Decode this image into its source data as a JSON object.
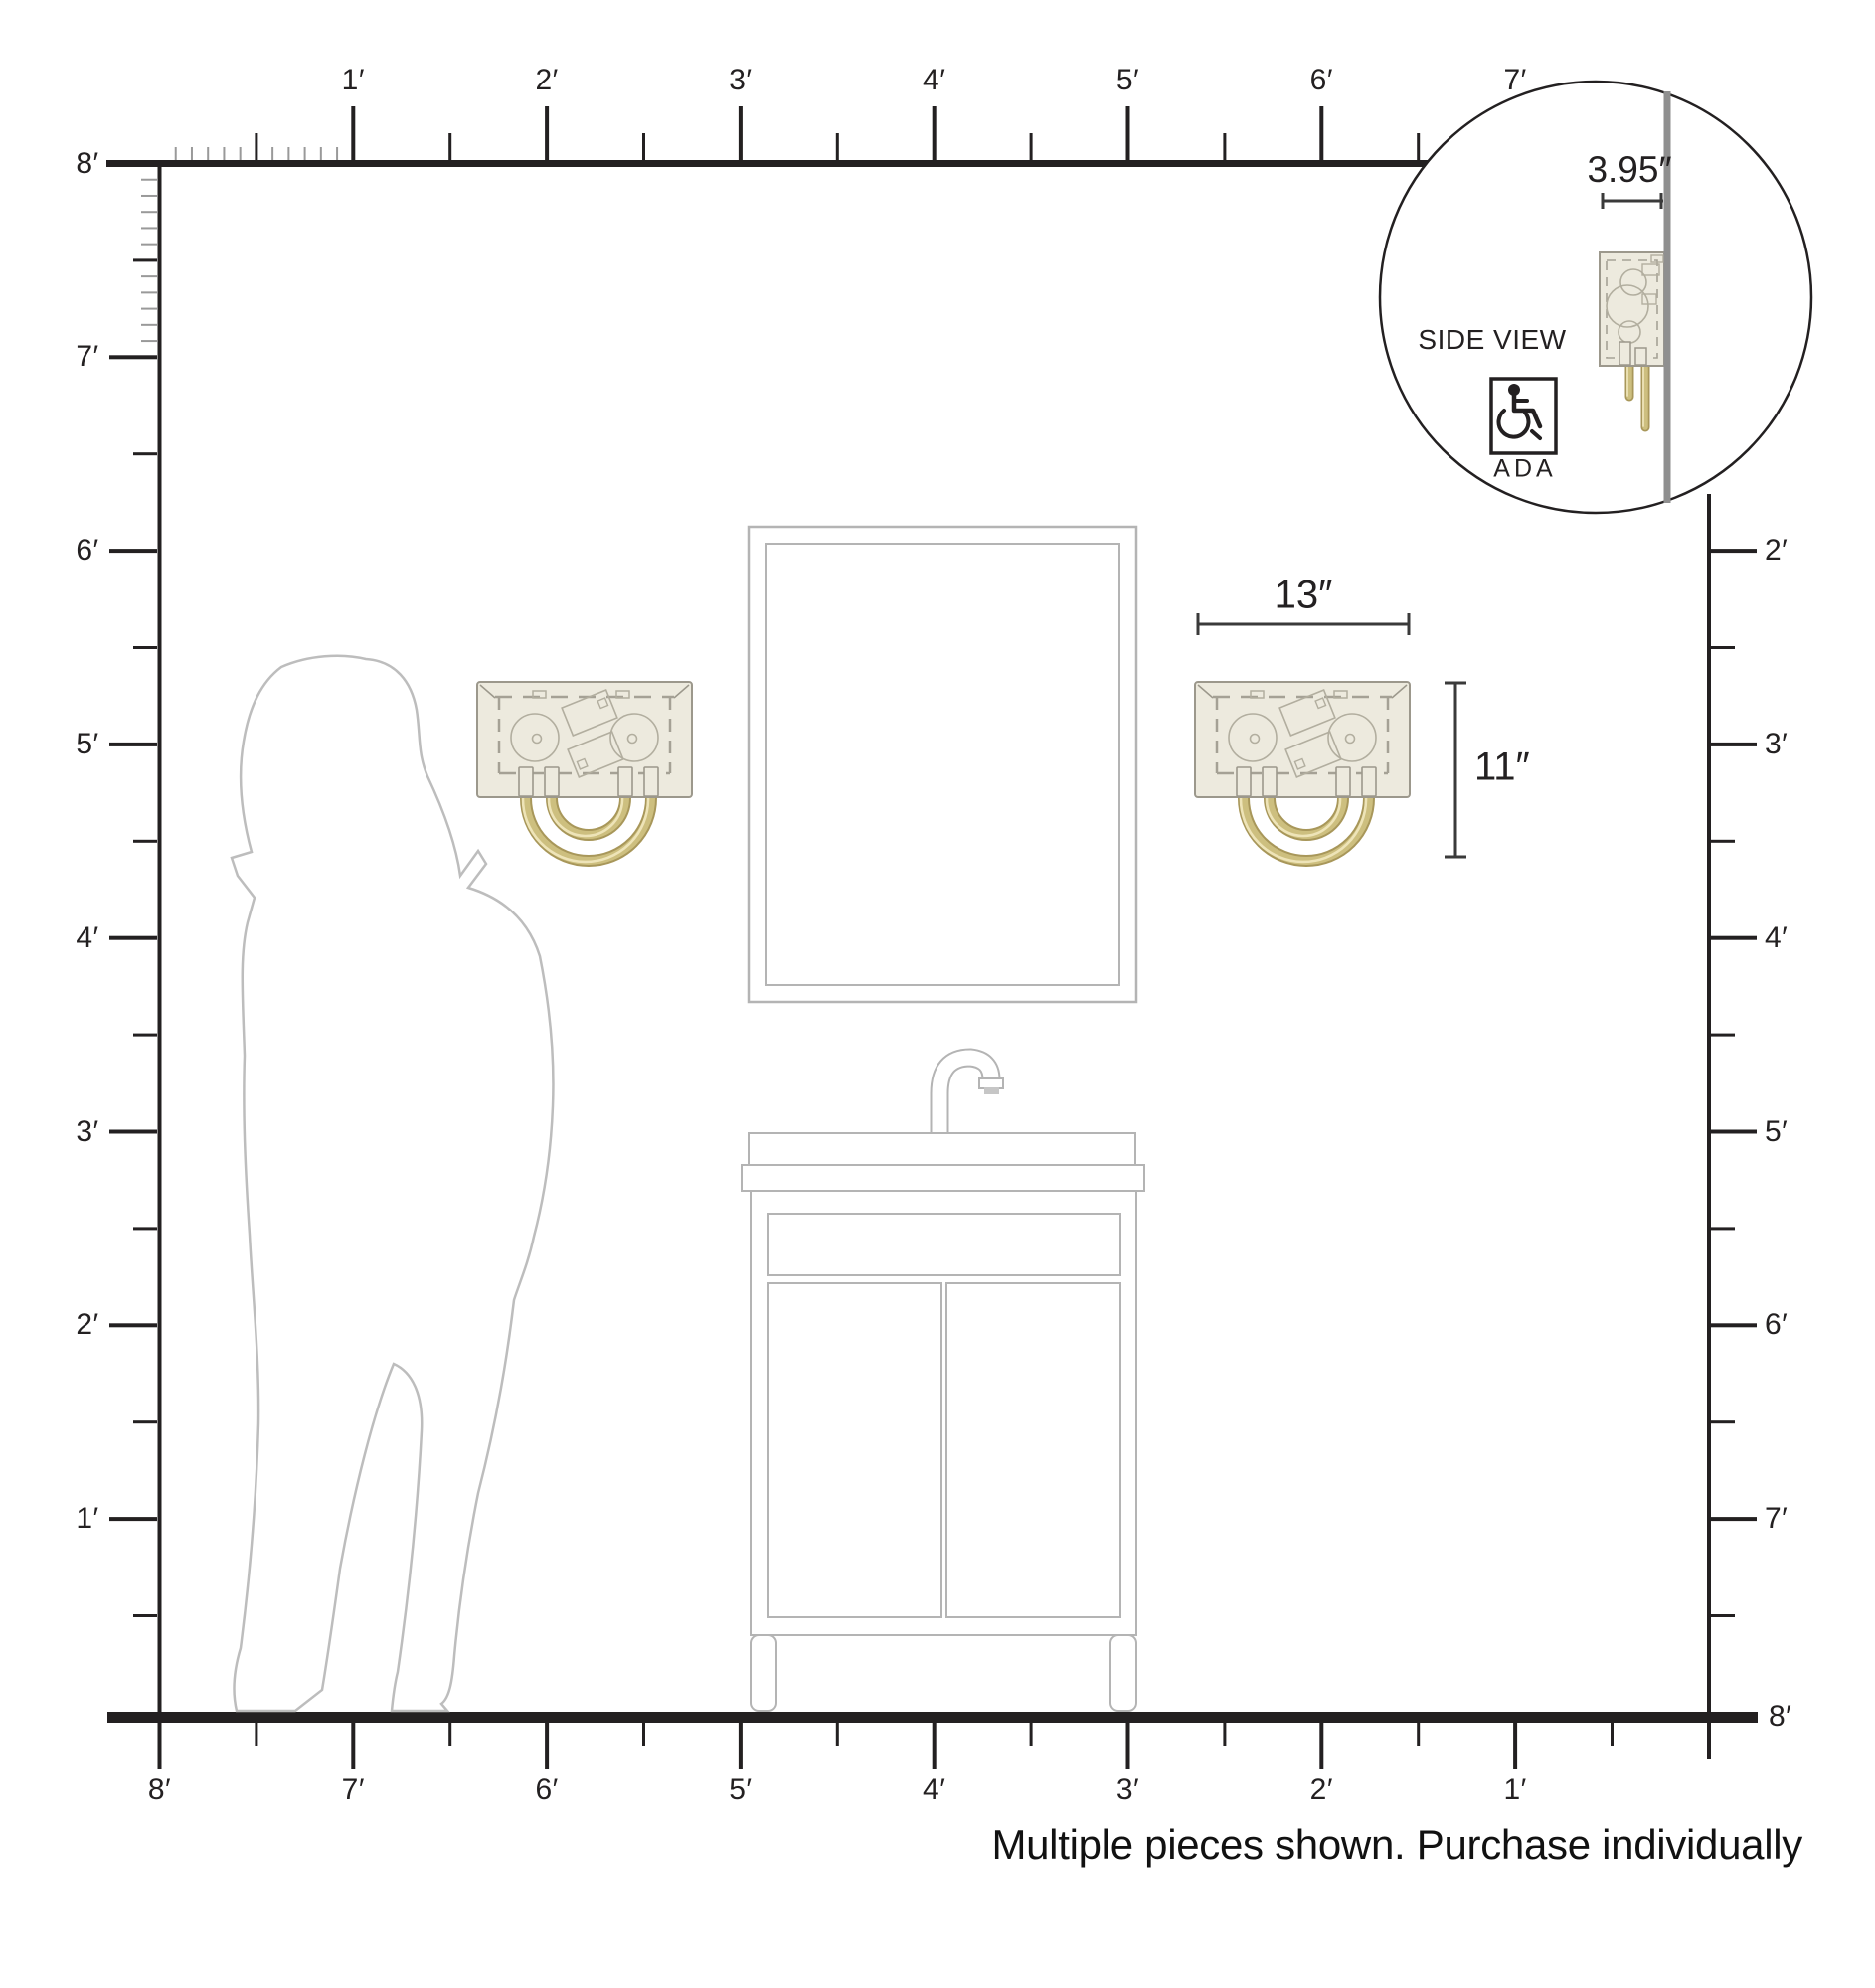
{
  "page": {
    "caption": "Multiple pieces shown. Purchase individually"
  },
  "fixture": {
    "width_label": "13″",
    "height_label": "11″",
    "depth_label": "3.95″"
  },
  "inset": {
    "side_view_label": "SIDE VIEW",
    "ada_label": "ADA",
    "ada_icon": "wheelchair-icon"
  },
  "rulers": {
    "unit": "feet",
    "top_labels": [
      "1′",
      "2′",
      "3′",
      "4′",
      "5′",
      "6′",
      "7′"
    ],
    "left_labels": [
      "8′",
      "7′",
      "6′",
      "5′",
      "4′",
      "3′",
      "2′",
      "1′"
    ],
    "right_labels": [
      "2′",
      "3′",
      "4′",
      "5′",
      "6′",
      "7′",
      "8′"
    ],
    "bottom_labels": [
      "8′",
      "7′",
      "6′",
      "5′",
      "4′",
      "3′",
      "2′",
      "1′"
    ],
    "span_feet": 8
  },
  "colors": {
    "dark": "#232021",
    "line_gray": "#b4b4b4",
    "silhouette_gray": "#bdbdbd",
    "shade_fill": "#edeade",
    "brass": "#cdbf7f",
    "brass_dark": "#a8975a",
    "brass_highlight": "#eee4b8",
    "wall_gray": "#8f8f8f"
  }
}
